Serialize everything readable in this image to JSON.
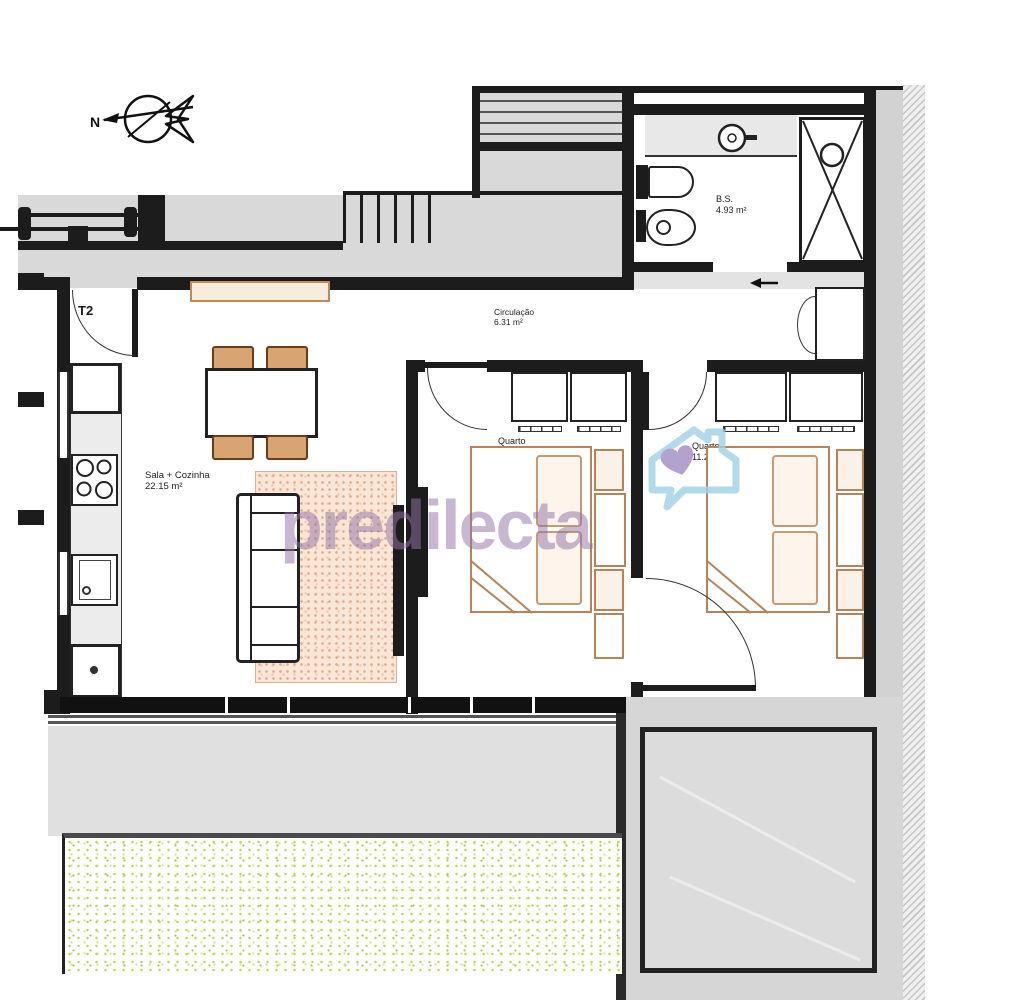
{
  "plan": {
    "compass_label": "N",
    "unit_type": "T2",
    "rooms": {
      "living": {
        "name": "Sala + Cozinha",
        "area": "22.15 m²"
      },
      "hall": {
        "name": "Circulação",
        "area": "6.31 m²"
      },
      "bedroom1": {
        "name": "Quarto",
        "area": "10.74 m²"
      },
      "bedroom2": {
        "name": "Quarto",
        "area": "11.28 m²"
      },
      "bathroom": {
        "name": "B.S.",
        "area": "4.93 m²"
      }
    }
  },
  "watermark": {
    "brand": "predilecta"
  },
  "colors": {
    "wall": "#1c1c1c",
    "common_floor": "#d9d9d9",
    "furniture_tan": "#b9835a",
    "rug_pink": "#f9e6d6",
    "grass_green": "#c3d25e",
    "watermark_purple": "#9374a6",
    "logo_blue": "#9fd2e4",
    "logo_heart": "#a18ac2"
  }
}
